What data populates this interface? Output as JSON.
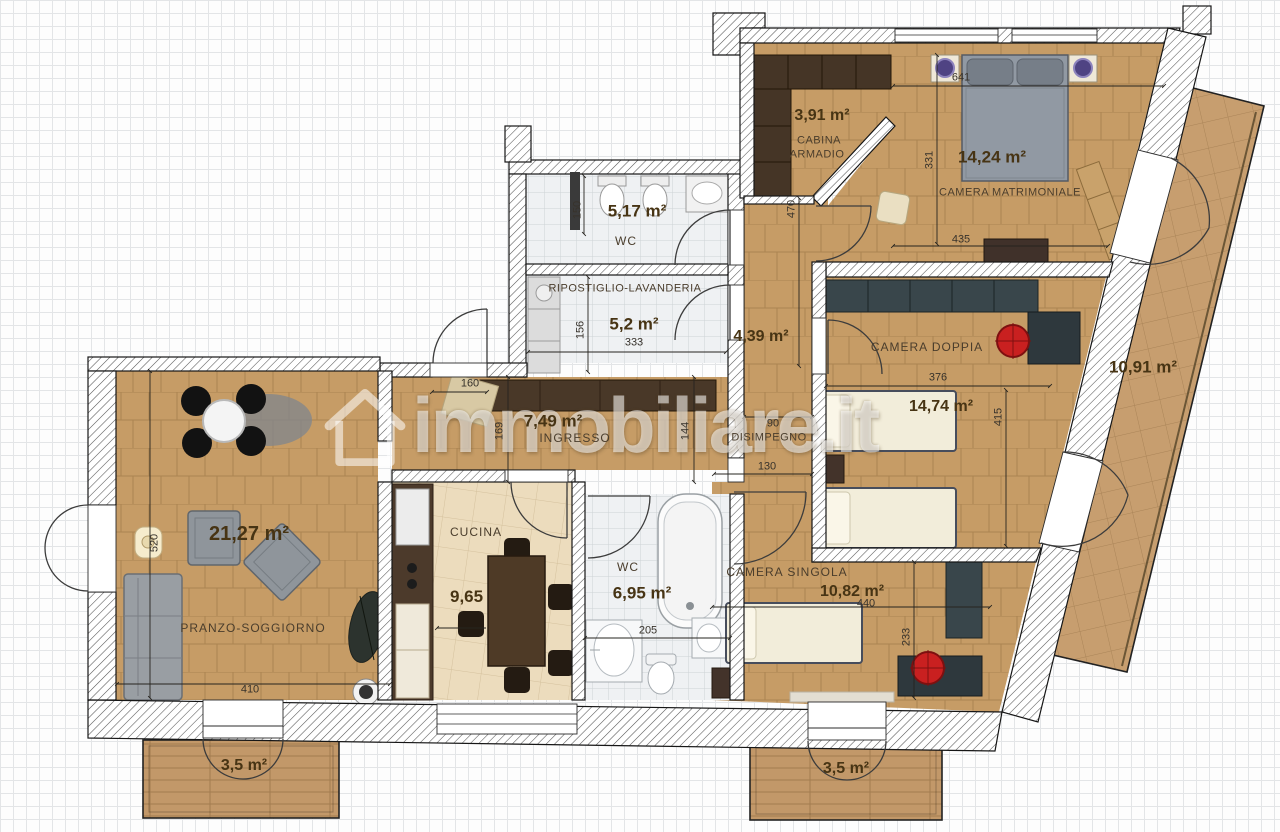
{
  "watermark": {
    "text": "immobiliare.it"
  },
  "rooms": {
    "soggiorno": {
      "name": "PRANZO-SOGGIORNO",
      "area": "21,27 m²",
      "dim_width": "410",
      "dim_height": "520"
    },
    "cucina": {
      "name": "CUCINA",
      "area": "9,65 m²",
      "dim_width": "284"
    },
    "ingresso": {
      "name": "INGRESSO",
      "area": "7,49 m²",
      "dim_door": "160",
      "dim_left": "169",
      "dim_right": "144"
    },
    "wc_notte": {
      "name": "WC",
      "area": "5,17 m²",
      "dim_stub": "150"
    },
    "lavanderia": {
      "name": "RIPOSTIGLIO-LAVANDERIA",
      "area": "5,2 m²",
      "dim_width": "333",
      "dim_height": "156"
    },
    "corridoio": {
      "area": "4,39 m²",
      "dim_length": "470"
    },
    "disimpegno": {
      "name": "DISIMPEGNO",
      "dim_top": "90",
      "dim_bottom": "130"
    },
    "cabina_armadio": {
      "name_line1": "CABINA",
      "name_line2": "ARMADIO",
      "area": "3,91 m²"
    },
    "matrimoniale": {
      "name": "CAMERA MATRIMONIALE",
      "area": "14,24 m²",
      "dim_top": "641",
      "dim_left": "331",
      "dim_bottom": "435"
    },
    "doppia": {
      "name": "CAMERA DOPPIA",
      "area": "14,74 m²",
      "dim_width": "376",
      "dim_height": "415"
    },
    "singola": {
      "name": "CAMERA SINGOLA",
      "area": "10,82 m²",
      "dim_width": "440",
      "dim_height": "233"
    },
    "bagno": {
      "name": "WC",
      "area": "6,95 m²",
      "dim_width": "205"
    },
    "terrazzo": {
      "area": "10,91 m²"
    },
    "balcone_sx": {
      "area": "3,5 m²"
    },
    "balcone_dx": {
      "area": "3,5 m²"
    }
  }
}
